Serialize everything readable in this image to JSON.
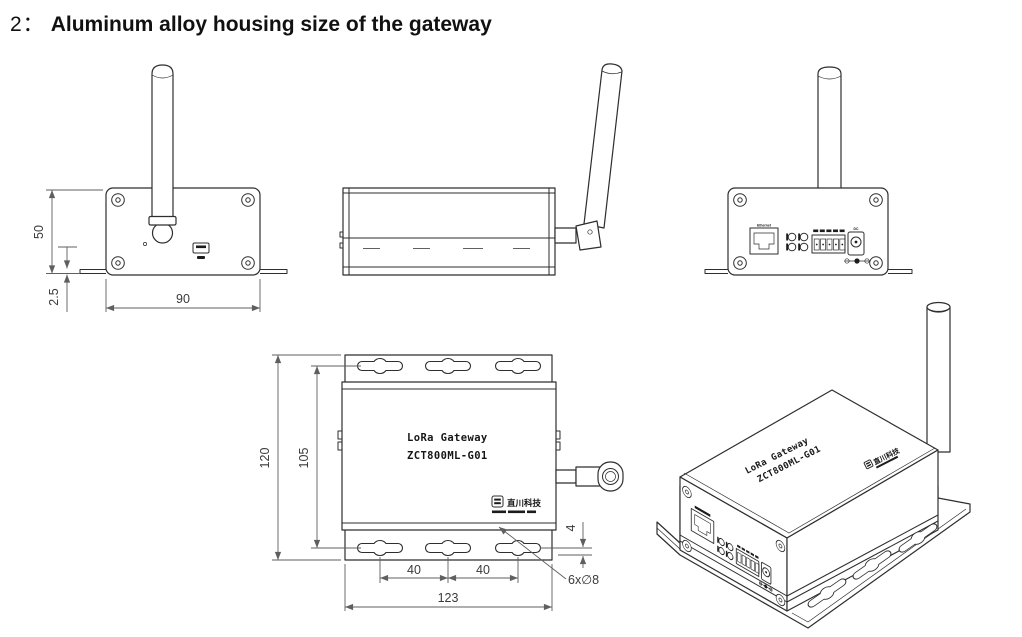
{
  "title": {
    "prefix": "2：",
    "text": "Aluminum alloy housing size of the gateway"
  },
  "product": {
    "name": "LoRa Gateway",
    "model": "ZCT800ML-G01",
    "brand": "直川科技"
  },
  "dimensions": {
    "front_height": "50",
    "front_flange_thickness": "2.5",
    "front_width": "90",
    "top_overall_length": "120",
    "top_hole_pitch_vertical": "105",
    "top_hole_pitch_a": "40",
    "top_hole_pitch_b": "40",
    "top_overall_width": "123",
    "top_flange_offset": "4",
    "top_holes_note": "6x∅8"
  },
  "back_panel": {
    "ethernet_label": "Ethernet",
    "dc_label": "DC"
  },
  "colors": {
    "line": "#2e2e2e",
    "dimension": "#5f5f5f",
    "background": "#ffffff"
  }
}
